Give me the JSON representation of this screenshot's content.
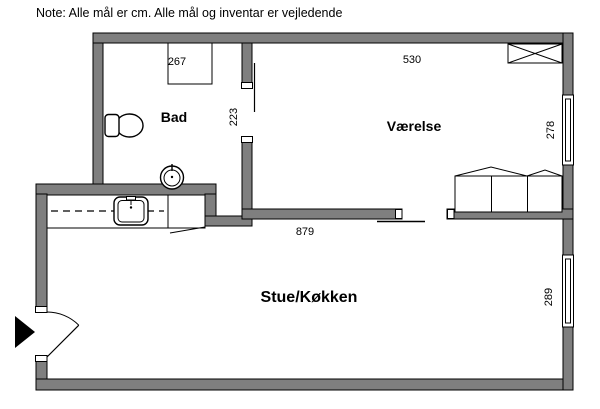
{
  "note": "Note: Alle mål er cm. Alle mål og inventar er vejledende",
  "rooms": {
    "bad": {
      "label": "Bad"
    },
    "vaerelse": {
      "label": "Værelse"
    },
    "stue_koekken": {
      "label": "Stue/Køkken"
    }
  },
  "dimensions_cm": {
    "bad_width": "267",
    "bad_wall": "223",
    "vaerelse_width": "530",
    "vaerelse_window": "278",
    "stue_width": "879",
    "stue_window": "289"
  },
  "fixtures": {
    "toilet": "toilet",
    "hand_basin": "hand-basin",
    "shower_cabinet": "shower-cabinet",
    "kitchen_counter": "kitchen-counter",
    "kitchen_sink": "kitchen-sink",
    "wardrobe_top": "wardrobe-with-x",
    "wardrobe_row": "wardrobe-row-3-doors",
    "entrance_door": "entrance-door-swing",
    "entrance_arrow": "entrance-arrow",
    "sliding_door": "sliding-door",
    "windows": "double-line-windows"
  },
  "colors": {
    "wall": "#7f7f7f",
    "outline": "#000000",
    "background": "#ffffff"
  }
}
